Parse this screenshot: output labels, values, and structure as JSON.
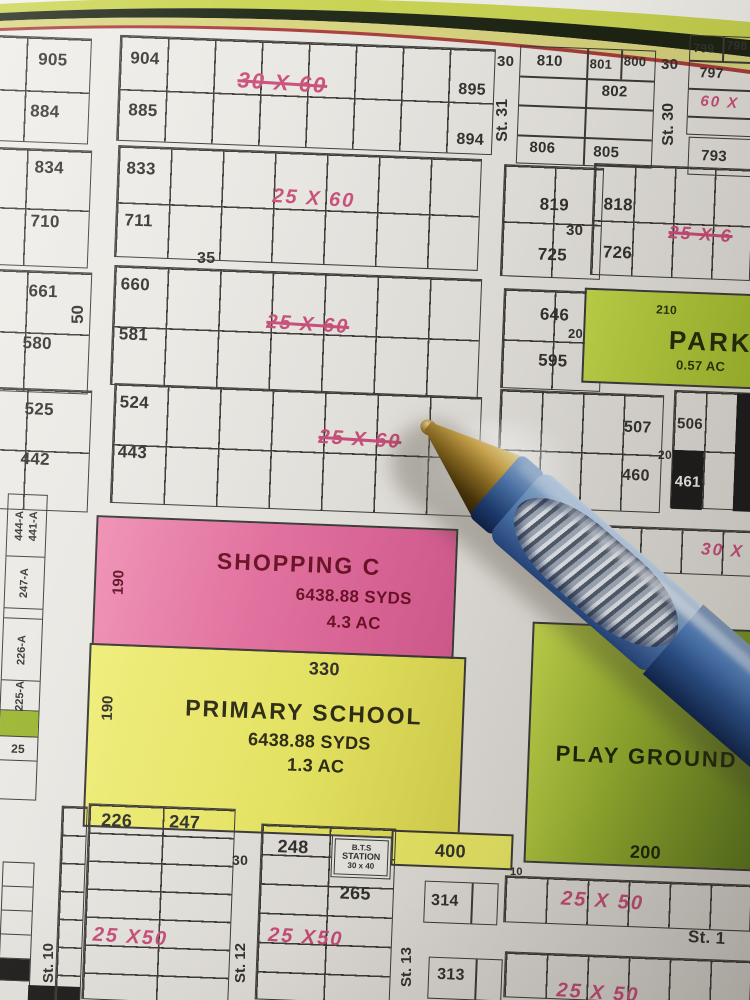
{
  "colors": {
    "annotation_pink": "#c94d79",
    "park_green": "#b5cc34",
    "school_yellow": "#ecea65",
    "shopping_pink": "#e671a1",
    "playground_green": "#9ab52f",
    "pen_blue": "#3e6db5"
  },
  "blocks": {
    "a": {
      "plots": [
        "905",
        "884"
      ]
    },
    "b": {
      "plots": [
        "904",
        "885",
        "895",
        "894"
      ],
      "size": "30 X 60"
    },
    "c": {
      "plots": [
        "810",
        "801",
        "800",
        "802",
        "806",
        "805"
      ]
    },
    "d": {
      "plots": [
        "799",
        "798",
        "797",
        "793"
      ],
      "size": "60 X"
    },
    "e": {
      "plots": [
        "834",
        "710"
      ]
    },
    "f": {
      "plots": [
        "833",
        "711"
      ],
      "size": "25 X 60"
    },
    "g": {
      "plots": [
        "819",
        "725"
      ]
    },
    "h": {
      "plots": [
        "818",
        "726"
      ],
      "size": "25 X 6"
    },
    "i": {
      "plots": [
        "661",
        "580"
      ]
    },
    "j": {
      "plots": [
        "660",
        "581"
      ],
      "size": "25 X 60"
    },
    "k": {
      "plots": [
        "646",
        "595"
      ]
    },
    "park": {
      "dim": "210",
      "name": "PARK",
      "area": "0.57 AC"
    },
    "l": {
      "plots": [
        "525",
        "442"
      ]
    },
    "m": {
      "plots": [
        "524",
        "443"
      ],
      "size": "25 X 60"
    },
    "n": {
      "plots": [
        "507",
        "460"
      ]
    },
    "o": {
      "plots": [
        "506",
        "461"
      ]
    },
    "p": {
      "size": "30 X"
    },
    "left_strip": {
      "plots": [
        "444-A",
        "441-A",
        "247-A",
        "226-A",
        "225-A",
        "25"
      ]
    },
    "shopping": {
      "dim": "190",
      "name": "SHOPPING C",
      "syds": "6438.88 SYDS",
      "ac": "4.3 AC"
    },
    "school": {
      "top": "330",
      "left": "190",
      "name": "PRIMARY SCHOOL",
      "syds": "6438.88 SYDS",
      "ac": "1.3 AC",
      "bottom": "400"
    },
    "playground": {
      "name": "PLAY GROUND",
      "bottom": "200"
    },
    "r": {
      "plots": [
        "226",
        "247"
      ],
      "size": "25 X50"
    },
    "s": {
      "plots": [
        "248",
        "265"
      ],
      "size": "25 X50",
      "bts": [
        "B.T.S",
        "STATION",
        "30 x 40"
      ]
    },
    "t": {
      "size": "25 X 50"
    },
    "u": {
      "size": "25 X 50"
    },
    "v": {
      "plots": [
        "314",
        "313"
      ]
    }
  },
  "streets": {
    "st31": {
      "width": "30",
      "name": "St. 31"
    },
    "st30": {
      "width": "30",
      "name": "St. 30"
    },
    "w35": "35",
    "w50": "50",
    "w30_mid": "30",
    "w20_park": "20",
    "w20_plots": "20",
    "w15": "15",
    "w10": "10",
    "w30_bottom": "30",
    "st10": "St. 10",
    "st12": "St. 12",
    "st13": "St. 13",
    "st14": "St. 1"
  }
}
